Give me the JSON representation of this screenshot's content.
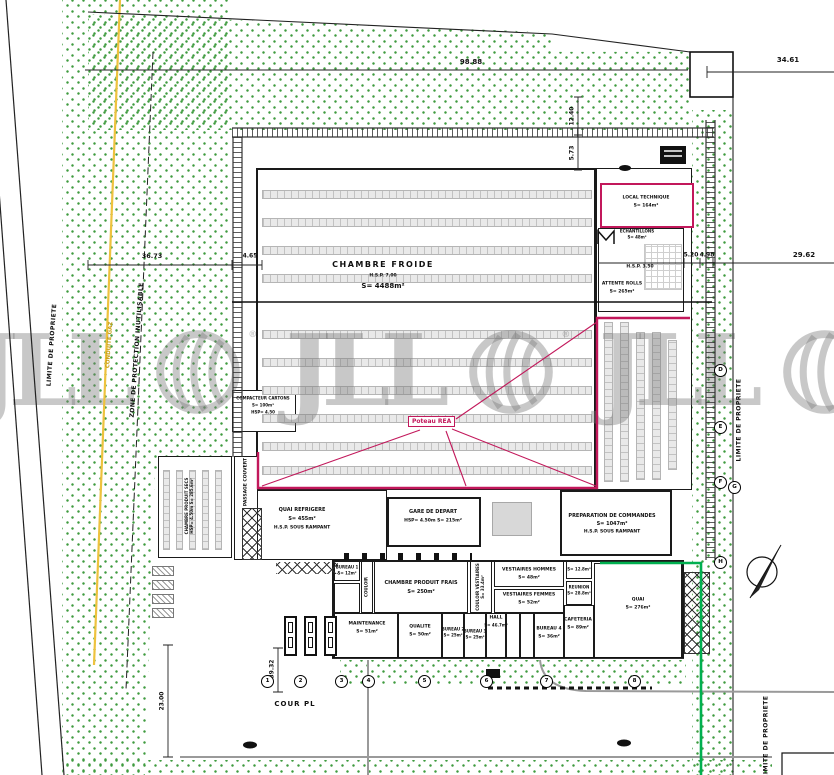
{
  "watermark": {
    "brand": "JLL",
    "registered": "®"
  },
  "colors": {
    "vegetation": "#3f9b3f",
    "red_outline": "#c2185b",
    "gas_line": "#eec23e",
    "green_boundary": "#00b050",
    "watermark_gray": "#7d7d7d"
  },
  "boundaries": {
    "limite_left": "LIMITE DE PROPRIETE",
    "limite_right": "LIMITE DE PROPRIETE",
    "limite_bottom": "LIMITE DE PROPRIETE",
    "zone_protection": "ZONE DE PROTECTION INUTILISABLE",
    "conduite_gaz": "CONDUITE GAZ"
  },
  "dimensions": {
    "top": "98.88",
    "top_right": "34.61",
    "right": "29.62",
    "d12_40": "12.40",
    "d5_73": "5.73",
    "d36_73": "36.73",
    "d4_65": "4.65",
    "d5_20": "5.20",
    "d4_98": "4.98",
    "d23_00": "23.00",
    "d39_32": "39.32"
  },
  "grid": {
    "cols": [
      "1",
      "2",
      "3",
      "4",
      "5",
      "6",
      "7",
      "8"
    ],
    "rows": [
      "D",
      "E",
      "F",
      "G",
      "H"
    ]
  },
  "site": {
    "cour_label": "COUR PL",
    "poteau_label": "Poteau REA"
  },
  "rooms": {
    "chambre_froide": {
      "name": "CHAMBRE FROIDE",
      "hsp": "H.S.P. 7.00",
      "area": "S= 4488m²"
    },
    "local_technique": {
      "name": "LOCAL TECHNIQUE",
      "area": "S= 164m²"
    },
    "echantillons": {
      "name": "ECHANTILLONS",
      "area": "S= 48m²"
    },
    "attente_rolls": {
      "name": "ATTENTE ROLLS",
      "area": "S= 265m²",
      "hsp": "H.S.P. 3.50"
    },
    "preparation_commandes": {
      "name": "PREPARATION DE COMMANDES",
      "area": "S= 1047m²",
      "hsp": "H.S.P. SOUS RAMPANT"
    },
    "quai_refrigere": {
      "name": "QUAI REFRIGERE",
      "area": "S= 455m²",
      "hsp": "H.S.P. SOUS RAMPANT"
    },
    "gare_de_depart": {
      "name": "GARE DE DEPART",
      "dims": "HSP= 4.50m   S= 215m²"
    },
    "compacteur_cartons": {
      "name": "COMPACTEUR CARTONS",
      "area": "S= 100m²",
      "hsp": "HSP= 4.50"
    },
    "chambre_produit_secs": {
      "name": "CHAMBRE PRODUIT SECS",
      "dims": "HSP= 4.50m  S= 285.6m²"
    },
    "passage_couvert": {
      "name": "PASSAGE COUVERT"
    },
    "bureau_1": {
      "name": "BUREAU 1",
      "area": "S= 12m²"
    },
    "couloir": {
      "name": "COULOIR"
    },
    "chambre_produit_frais": {
      "name": "CHAMBRE PRODUIT FRAIS",
      "area": "S= 250m²"
    },
    "couloir_vestiaires": {
      "name": "COULOIR VESTIAIRES",
      "area": "S= 33.4m²"
    },
    "vestiaires_hommes": {
      "name": "VESTIAIRES HOMMES",
      "area": "S= 48m²"
    },
    "vestiaires_femmes": {
      "name": "VESTIAIRES FEMMES",
      "area": "S= 52m²"
    },
    "local_12_8": {
      "area": "S= 12.8m²"
    },
    "reunion": {
      "name": "REUNION",
      "area": "S= 28.8m²"
    },
    "cafeteria": {
      "name": "CAFETERIA",
      "area": "S= 89m²"
    },
    "maintenance": {
      "name": "MAINTENANCE",
      "area": "S= 51m²"
    },
    "qualite": {
      "name": "QUALITE",
      "area": "S= 50m²"
    },
    "bureau_2": {
      "name": "BUREAU 2",
      "area": "S= 25m²"
    },
    "bureau_3": {
      "name": "BUREAU 3",
      "area": "S= 25m²"
    },
    "hall": {
      "name": "HALL",
      "area": "S= 46.7m²"
    },
    "bureau_4": {
      "name": "BUREAU 4",
      "area": "S= 36m²"
    },
    "quai": {
      "name": "QUAI",
      "area": "S= 276m²"
    }
  }
}
